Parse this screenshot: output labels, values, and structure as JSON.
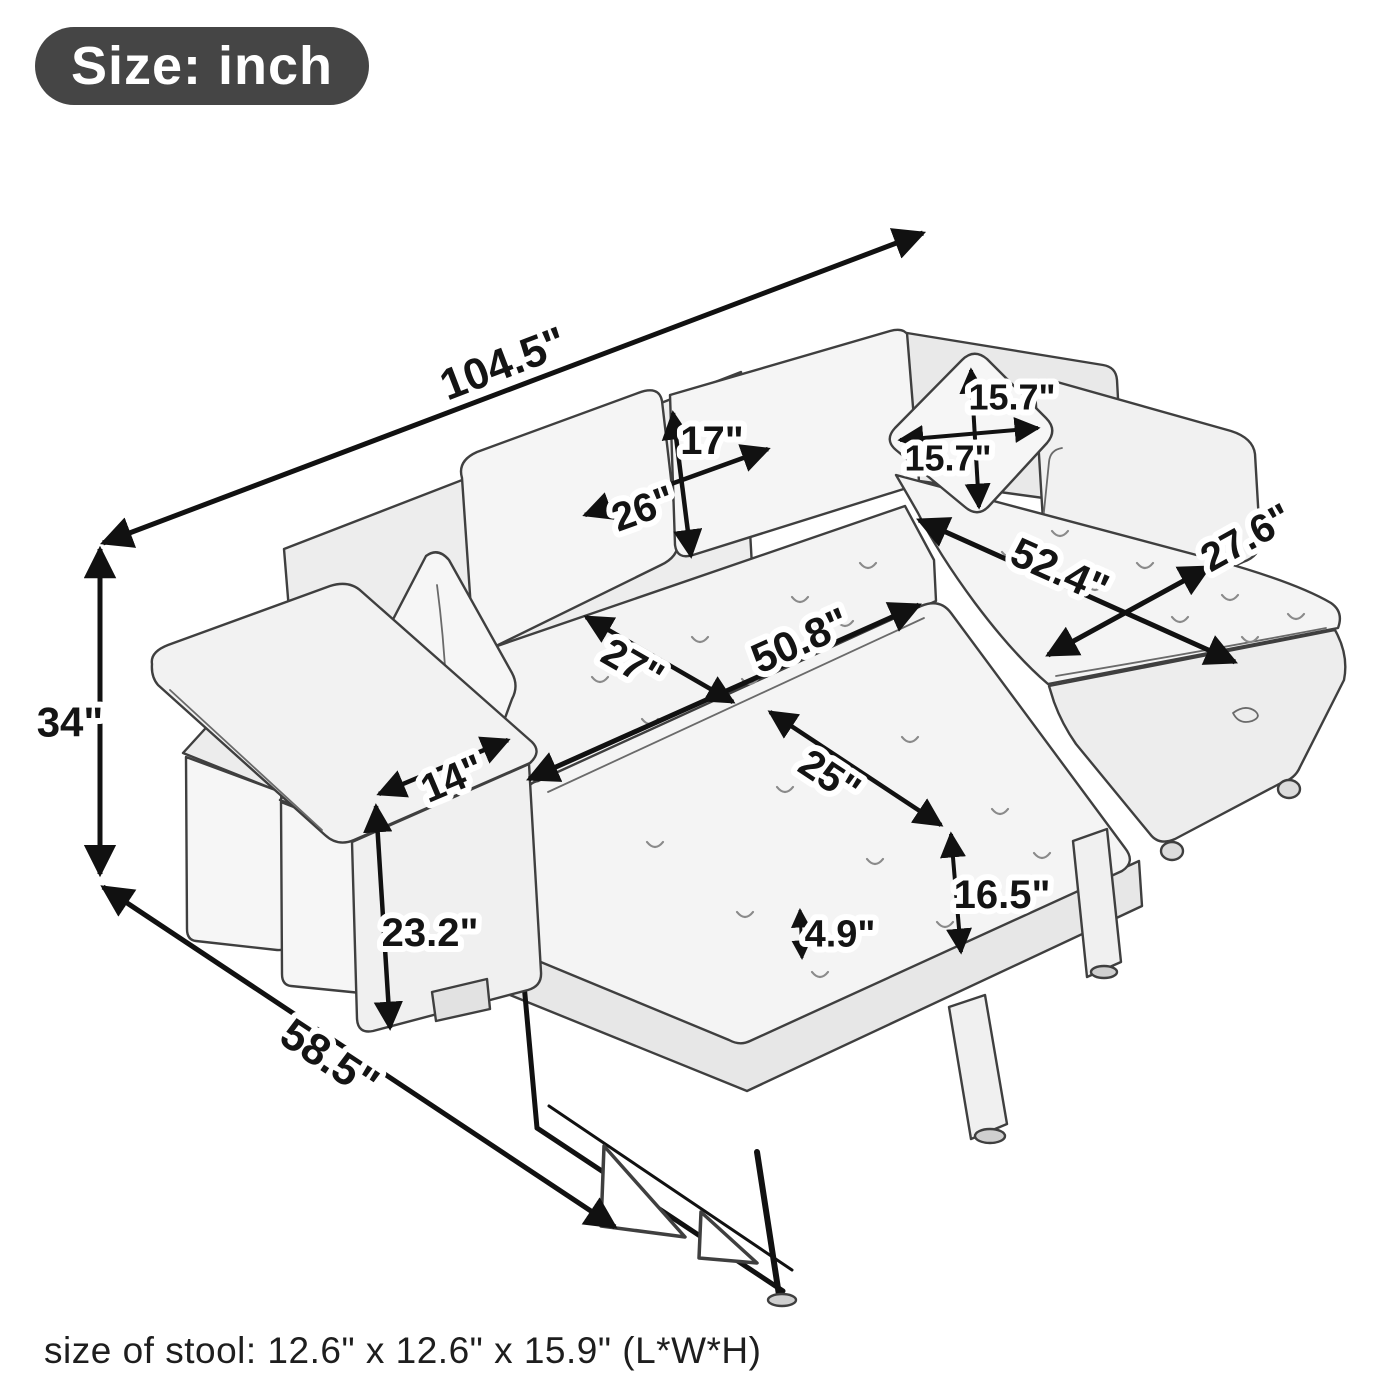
{
  "badge": {
    "label": "Size: inch"
  },
  "footnote": {
    "text": "size of stool: 12.6\" x 12.6\" x 15.9\" (L*W*H)"
  },
  "dims": {
    "overall_width": "104.5\"",
    "overall_height": "34\"",
    "overall_depth": "58.5\"",
    "back_cushion_height": "17\"",
    "back_cushion_width": "26\"",
    "pillow_height": "15.7\"",
    "pillow_width": "15.7\"",
    "chaise_length": "52.4\"",
    "chaise_depth": "27.6\"",
    "sleeper_width": "50.8\"",
    "seat_depth": "27\"",
    "pullout_depth": "25\"",
    "pullout_height": "16.5\"",
    "mattress_thickness": "4.9\"",
    "armrest_width": "14\"",
    "armrest_height": "23.2\""
  },
  "colors": {
    "badge_background": "#454545",
    "badge_text": "#ffffff",
    "dimension_ink": "#111111",
    "sketch_line": "#3f3f3f",
    "sketch_fill": "#f3f3f3"
  }
}
